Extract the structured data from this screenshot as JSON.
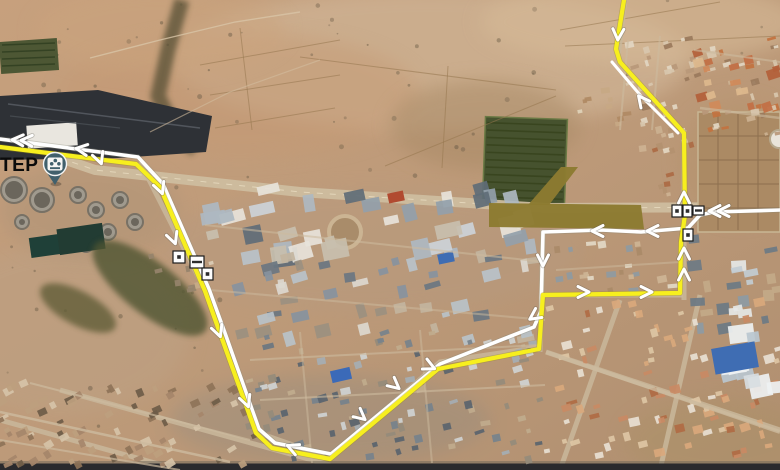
{
  "map": {
    "plant_label": "TEP",
    "label_style": {
      "color": "#0b0b0b",
      "size": 19
    },
    "pin": {
      "x": 55,
      "y": 164,
      "color": "#41606c",
      "icon": "treatment-plant-icon"
    },
    "zone_polygon": {
      "color": "#8c7b31",
      "body": [
        [
          489,
          203
        ],
        [
          641,
          205
        ],
        [
          644,
          229
        ],
        [
          489,
          227
        ]
      ],
      "arm": [
        [
          528,
          205
        ],
        [
          561,
          167
        ],
        [
          578,
          167
        ],
        [
          549,
          205
        ]
      ]
    },
    "routes": {
      "white": {
        "color": "#ffffff",
        "width": 3.6,
        "main": [
          [
            0,
            139
          ],
          [
            138,
            157
          ],
          [
            163,
            184
          ],
          [
            209,
            289
          ],
          [
            225,
            333
          ],
          [
            259,
            429
          ],
          [
            275,
            443
          ],
          [
            331,
            454
          ],
          [
            372,
            420
          ],
          [
            440,
            364
          ],
          [
            534,
            327
          ],
          [
            541,
            311
          ],
          [
            543,
            232
          ],
          [
            601,
            230
          ],
          [
            641,
            232
          ],
          [
            688,
            228
          ],
          [
            700,
            215
          ],
          [
            714,
            212
          ],
          [
            780,
            210
          ]
        ],
        "top_branch": [
          [
            612,
            62
          ],
          [
            641,
            96
          ],
          [
            678,
            133
          ]
        ]
      },
      "yellow": {
        "color": "#f7ef1e",
        "width": 4.2,
        "main": [
          [
            0,
            147
          ],
          [
            136,
            164
          ],
          [
            160,
            187
          ],
          [
            205,
            291
          ],
          [
            221,
            336
          ],
          [
            256,
            433
          ],
          [
            272,
            448
          ],
          [
            330,
            459
          ],
          [
            371,
            425
          ],
          [
            438,
            369
          ],
          [
            539,
            349
          ],
          [
            543,
            295
          ],
          [
            680,
            293
          ],
          [
            681,
            242
          ],
          [
            685,
            215
          ],
          [
            684,
            133
          ],
          [
            620,
            62
          ],
          [
            616,
            49
          ],
          [
            624,
            0
          ]
        ]
      }
    },
    "arrows": [
      {
        "x": 16,
        "y": 140,
        "a": 183,
        "d": true
      },
      {
        "x": 80,
        "y": 149,
        "a": 188
      },
      {
        "x": 100,
        "y": 160,
        "a": 70
      },
      {
        "x": 161,
        "y": 190,
        "a": 70
      },
      {
        "x": 174,
        "y": 240,
        "a": 70
      },
      {
        "x": 219,
        "y": 333,
        "a": 70
      },
      {
        "x": 247,
        "y": 403,
        "a": 70
      },
      {
        "x": 291,
        "y": 447,
        "a": 203
      },
      {
        "x": 362,
        "y": 417,
        "a": 40
      },
      {
        "x": 396,
        "y": 386,
        "a": 40
      },
      {
        "x": 431,
        "y": 367,
        "a": 25
      },
      {
        "x": 543,
        "y": 262,
        "a": 90
      },
      {
        "x": 533,
        "y": 317,
        "a": 145
      },
      {
        "x": 596,
        "y": 231,
        "a": 180
      },
      {
        "x": 651,
        "y": 231,
        "a": 180
      },
      {
        "x": 713,
        "y": 211,
        "a": 180,
        "d": true
      },
      {
        "x": 585,
        "y": 292,
        "a": 0
      },
      {
        "x": 648,
        "y": 292,
        "a": 0
      },
      {
        "x": 684,
        "y": 196,
        "a": 270
      },
      {
        "x": 684,
        "y": 252,
        "a": 270
      },
      {
        "x": 684,
        "y": 273,
        "a": 270
      },
      {
        "x": 618,
        "y": 36,
        "a": 93
      },
      {
        "x": 641,
        "y": 99,
        "a": 232
      }
    ],
    "markers": [
      {
        "x": 173,
        "y": 251,
        "w": 12,
        "h": 12
      },
      {
        "x": 190,
        "y": 256,
        "w": 14,
        "h": 12
      },
      {
        "x": 202,
        "y": 268,
        "w": 11,
        "h": 12
      },
      {
        "x": 672,
        "y": 205,
        "w": 10,
        "h": 12
      },
      {
        "x": 683,
        "y": 205,
        "w": 9,
        "h": 12
      },
      {
        "x": 693,
        "y": 206,
        "w": 11,
        "h": 9
      },
      {
        "x": 683,
        "y": 229,
        "w": 10,
        "h": 12
      }
    ]
  }
}
